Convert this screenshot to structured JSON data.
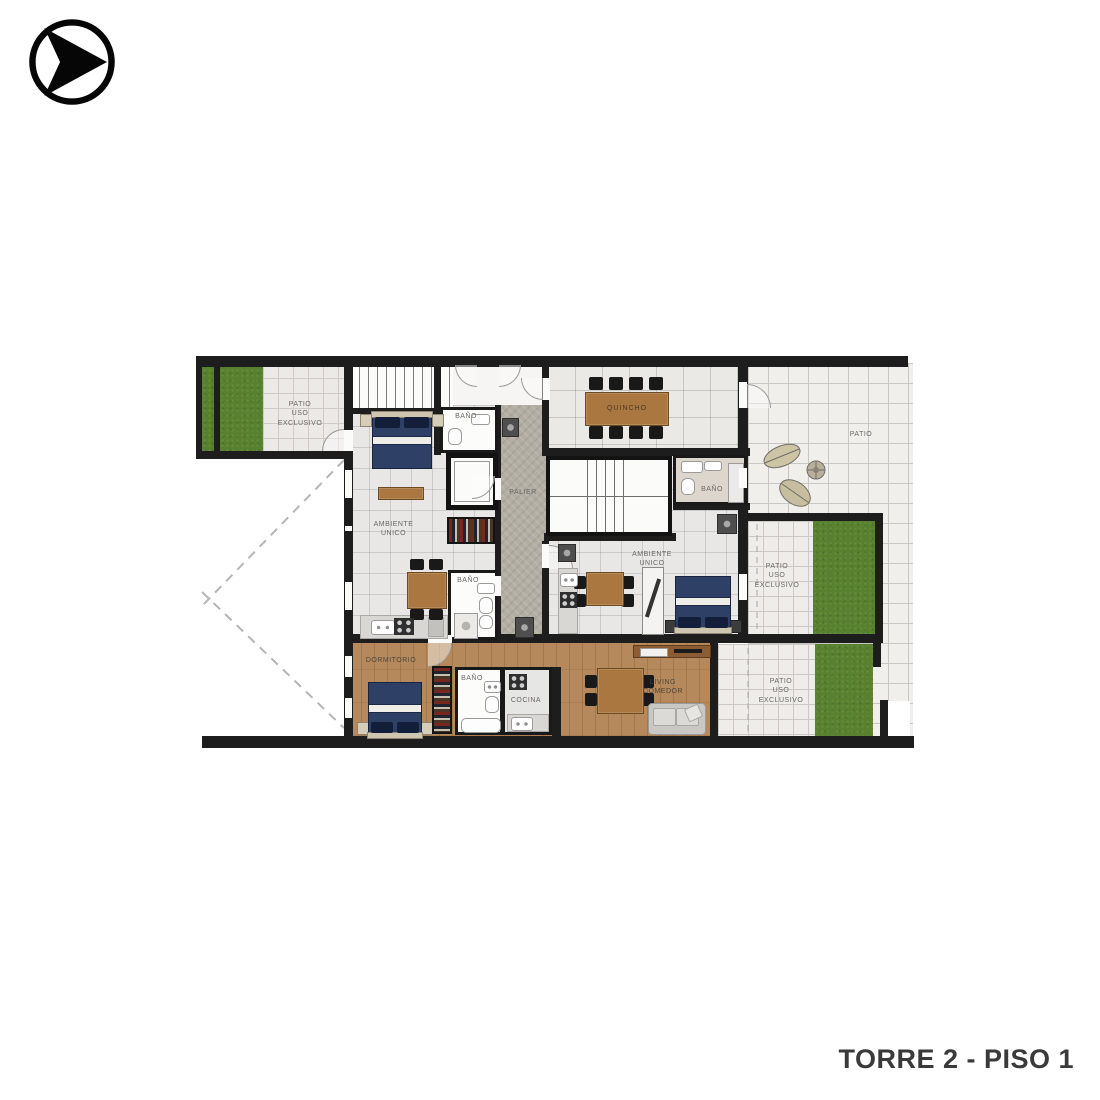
{
  "page": {
    "background": "#ffffff"
  },
  "logo": {
    "icon": "arrow-in-circle"
  },
  "footer": {
    "title": "TORRE 2 - PISO 1"
  },
  "palette": {
    "wall": "#1d1d1d",
    "tile": "#ebebeb",
    "tile_line": "#c9c7c3",
    "grass": "#57812e",
    "wood_floor": "#b5895c",
    "wood_furniture": "#a9773f",
    "bed": "#2e4065",
    "sofa": "#c9c8c5",
    "palier": "#b2aea3",
    "label_text": "#6a6865",
    "footer_text": "#3a3a3a"
  },
  "floorplan": {
    "labels": {
      "patio_top_left": "PATIO\nUSO\nEXCLUSIVO",
      "bano_top": "BAÑO",
      "quincho": "QUINCHO",
      "patio_right": "PATIO",
      "ambiente_unico_left": "AMBIENTE\nUNICO",
      "palier": "PALIER",
      "bano_right": "BAÑO",
      "ambiente_unico_right": "AMBIENTE\nUNICO",
      "patio_uso_right": "PATIO\nUSO\nEXCLUSIVO",
      "bano_left": "BAÑO",
      "dormitorio": "DORMITORIO",
      "bano_bottom": "BAÑO",
      "cocina": "COCINA",
      "living_comedor": "LIVING\nCOMEDOR",
      "patio_uso_bottom": "PATIO\nUSO\nEXCLUSIVO"
    }
  }
}
